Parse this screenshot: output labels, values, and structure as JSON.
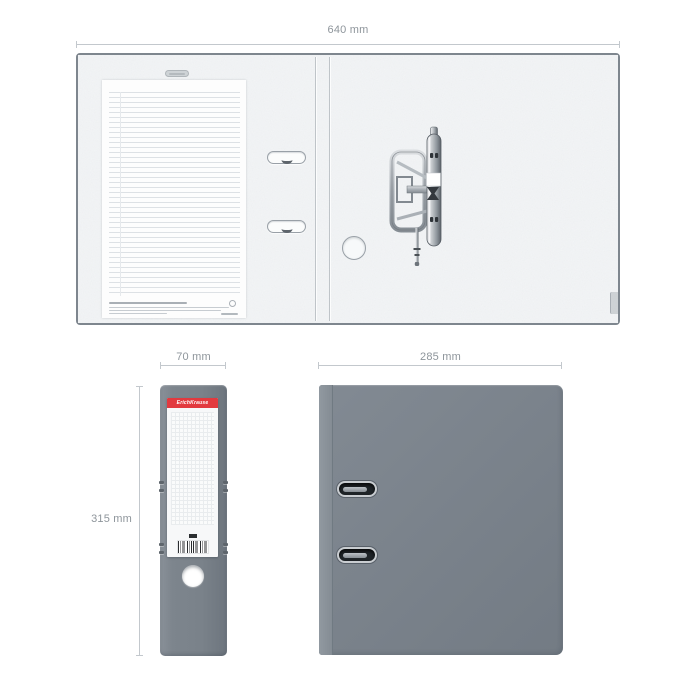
{
  "product": {
    "brand": "ErichKrause",
    "type": "lever-arch-file-binder"
  },
  "dimensions": {
    "open_width": "640 mm",
    "spine_width": "70 mm",
    "height": "315 mm",
    "cover_width": "285 mm"
  },
  "colors": {
    "binder_gray": "#7a828b",
    "spine_gray": "#7d858d",
    "brand_red": "#e23a3f",
    "interior_fiber": "#edeff1",
    "dimension_text": "#8e959b",
    "dimension_line": "#c3c8cd",
    "metal": "#9aa1a7"
  }
}
